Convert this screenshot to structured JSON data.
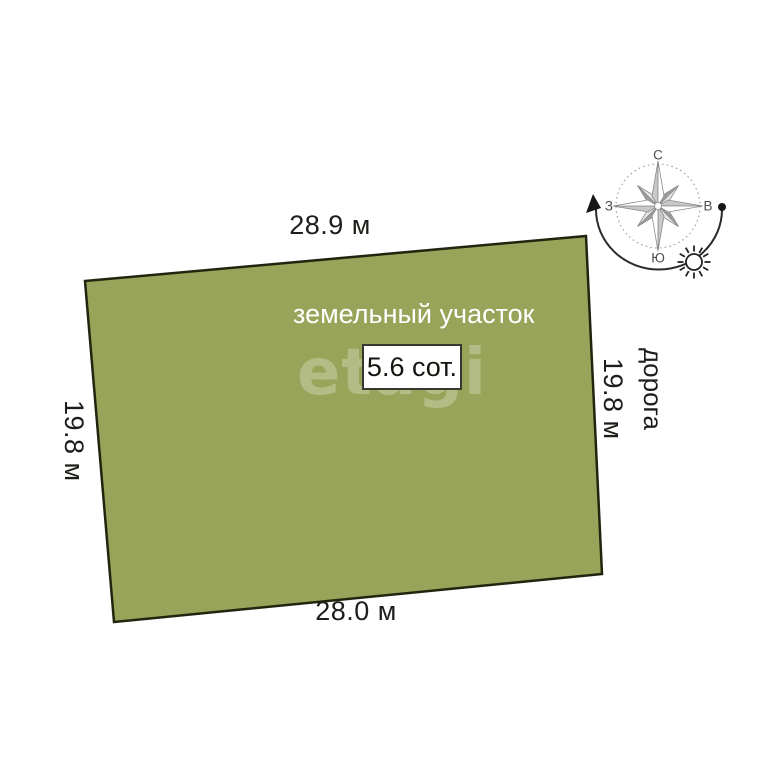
{
  "plot": {
    "name_label": "земельный участок",
    "area_label": "5.6 сот.",
    "fill_color": "#98a459",
    "border_color": "#23240f",
    "top_length": "28.9 м",
    "bottom_length": "28.0 м",
    "left_length": "19.8 м",
    "right_length": "19.8 м"
  },
  "road_label": "дорога",
  "watermark": "etagi",
  "compass": {
    "north_label": "С",
    "east_label": "В",
    "south_label": "Ю",
    "west_label": "З",
    "icons": [
      "compass-rose-icon",
      "sun-icon",
      "sun-path-arrow"
    ]
  }
}
